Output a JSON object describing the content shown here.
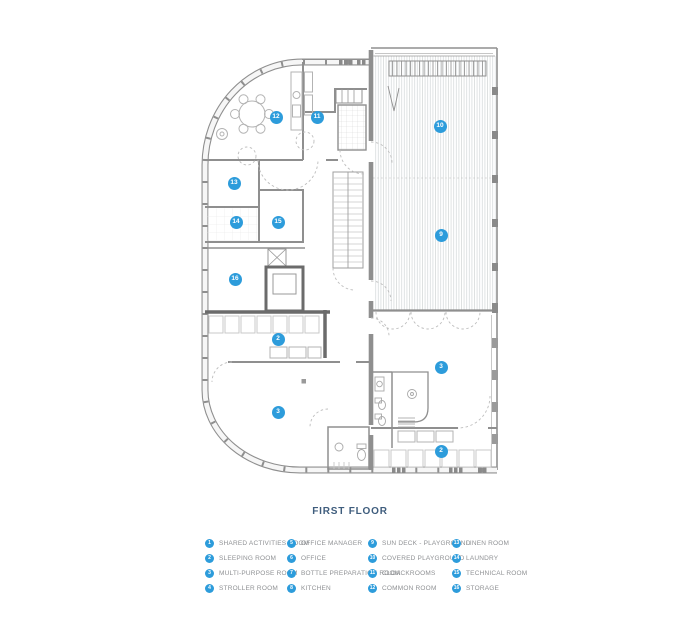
{
  "title": "FIRST FLOOR",
  "colors": {
    "accent": "#2D9CDB",
    "title": "#3F5D7D",
    "wall": "#8f8f8f",
    "heavy_wall": "#6b6b6b",
    "hatch": "#d2d6d8"
  },
  "plan": {
    "markers": [
      {
        "n": "12",
        "x": 276,
        "y": 117
      },
      {
        "n": "11",
        "x": 317,
        "y": 117
      },
      {
        "n": "10",
        "x": 440,
        "y": 126
      },
      {
        "n": "13",
        "x": 234,
        "y": 183
      },
      {
        "n": "14",
        "x": 236,
        "y": 222
      },
      {
        "n": "15",
        "x": 278,
        "y": 222
      },
      {
        "n": "16",
        "x": 235,
        "y": 279
      },
      {
        "n": "9",
        "x": 441,
        "y": 235
      },
      {
        "n": "2",
        "x": 278,
        "y": 339
      },
      {
        "n": "3",
        "x": 278,
        "y": 412
      },
      {
        "n": "3",
        "x": 441,
        "y": 367
      },
      {
        "n": "2",
        "x": 441,
        "y": 451
      }
    ]
  },
  "legend": {
    "items": [
      {
        "num": "1",
        "label": "SHARED ACTIVITIES ROOM"
      },
      {
        "num": "2",
        "label": "SLEEPING ROOM"
      },
      {
        "num": "3",
        "label": "MULTI-PURPOSE ROOM"
      },
      {
        "num": "4",
        "label": "STROLLER ROOM"
      },
      {
        "num": "5",
        "label": "OFFICE MANAGER"
      },
      {
        "num": "6",
        "label": "OFFICE"
      },
      {
        "num": "7",
        "label": "BOTTLE PREPARATION ROOM"
      },
      {
        "num": "8",
        "label": "KITCHEN"
      },
      {
        "num": "9",
        "label": "SUN DECK - PLAYGROUND"
      },
      {
        "num": "10",
        "label": "COVERED PLAYGROUND"
      },
      {
        "num": "11",
        "label": "CLOACKROOMS"
      },
      {
        "num": "12",
        "label": "COMMON ROOM"
      },
      {
        "num": "13",
        "label": "LINEN ROOM"
      },
      {
        "num": "14",
        "label": "LAUNDRY"
      },
      {
        "num": "15",
        "label": "TECHNICAL ROOM"
      },
      {
        "num": "16",
        "label": "STORAGE"
      }
    ]
  }
}
